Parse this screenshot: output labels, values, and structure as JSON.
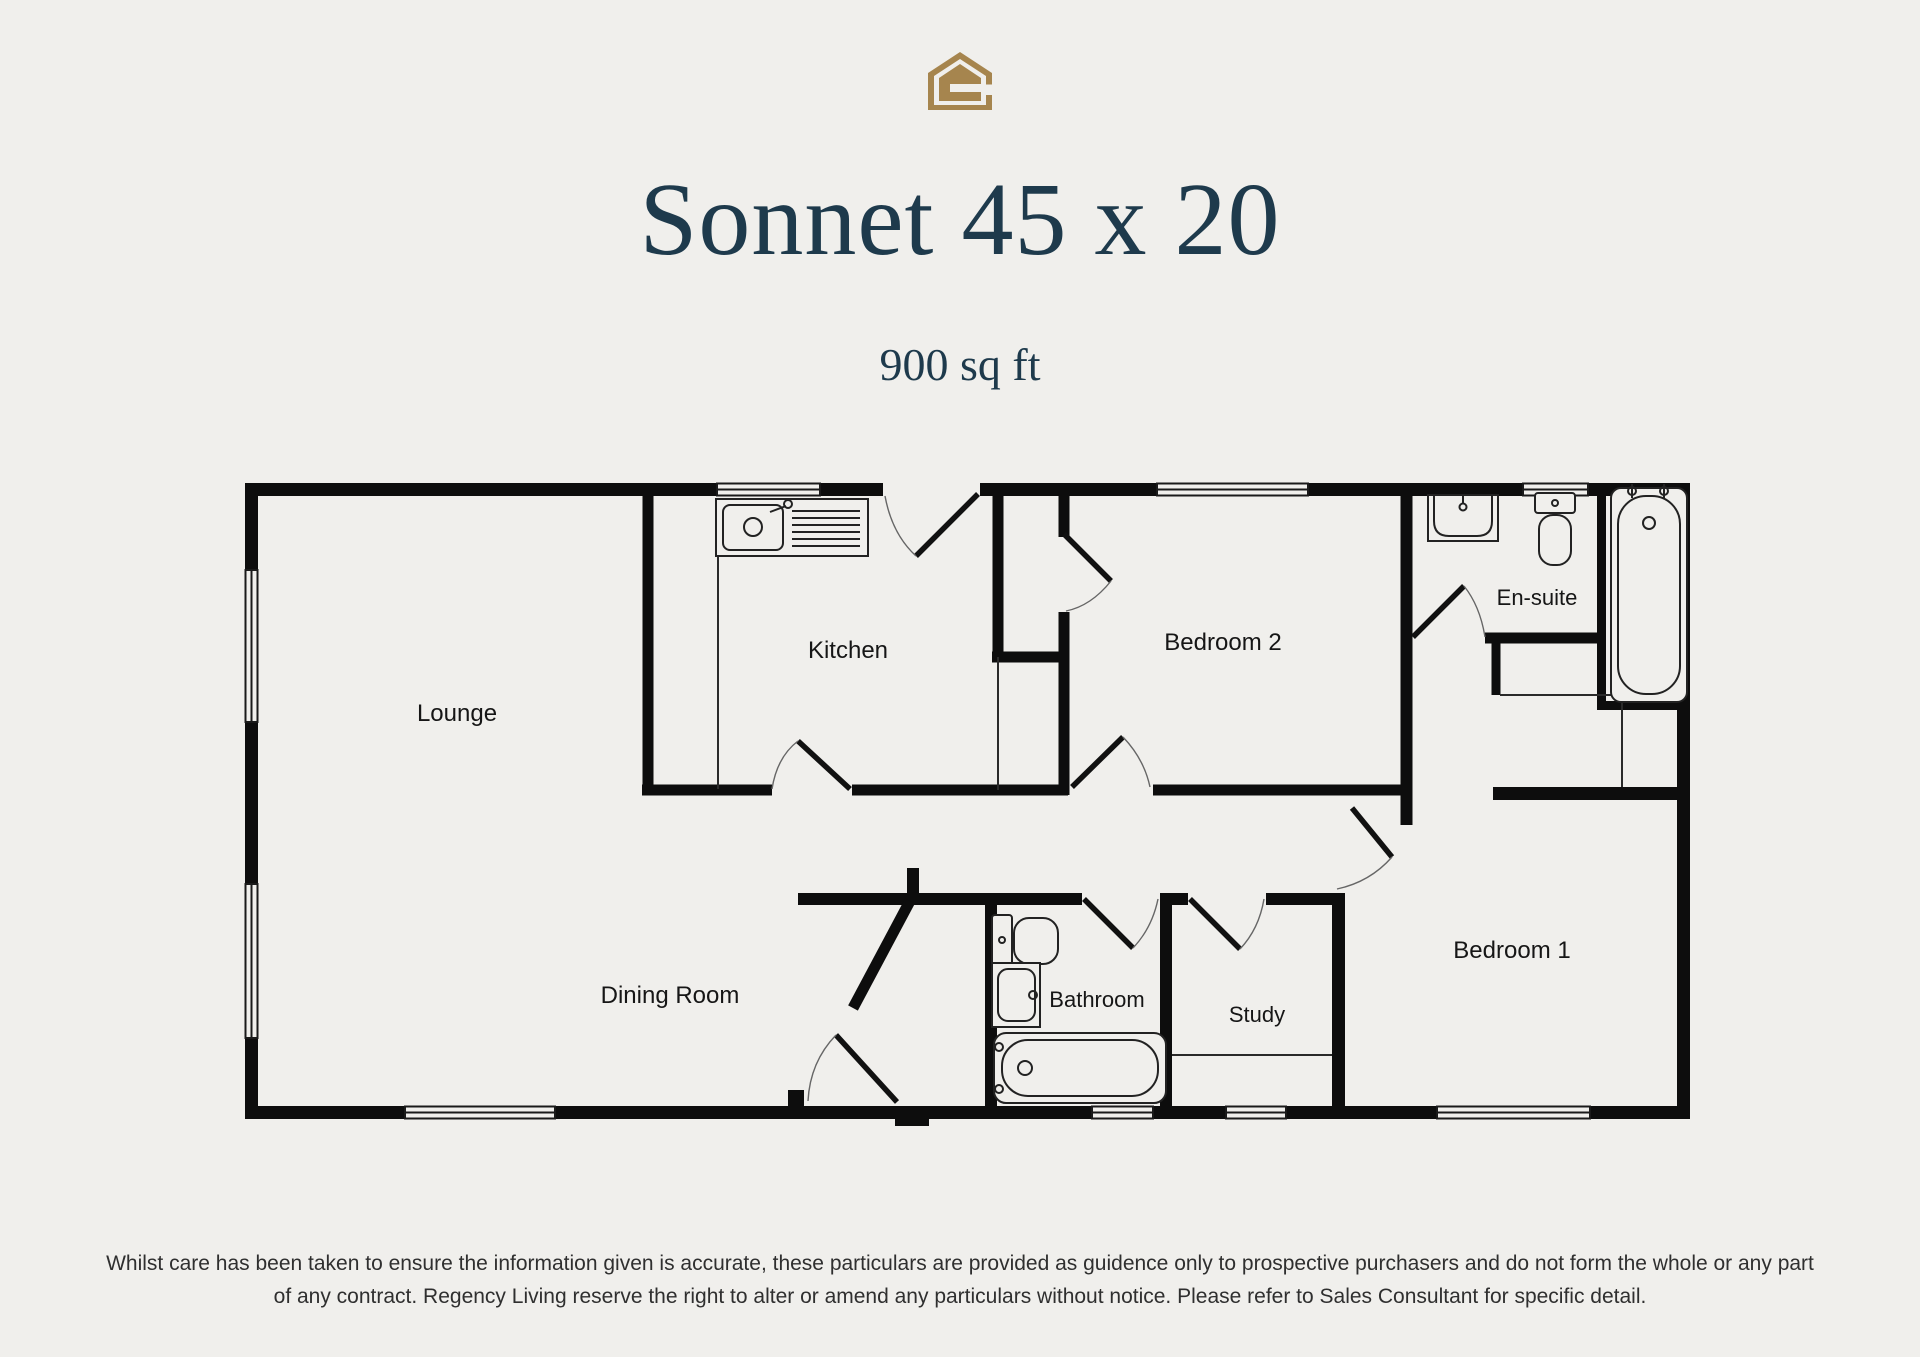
{
  "colors": {
    "background": "#f0efec",
    "wall": "#0d0d0d",
    "title_navy": "#1e3a4c",
    "logo_gold": "#a6854e",
    "disclaimer_gray": "#2f2f2f"
  },
  "header": {
    "logo_icon": "regency-living-house-logo",
    "title": "Sonnet 45 x 20",
    "subtitle": "900 sq ft"
  },
  "plan": {
    "rooms": [
      {
        "id": "lounge",
        "label": "Lounge"
      },
      {
        "id": "kitchen",
        "label": "Kitchen"
      },
      {
        "id": "bedroom-2",
        "label": "Bedroom 2"
      },
      {
        "id": "en-suite",
        "label": "En-suite"
      },
      {
        "id": "dining-room",
        "label": "Dining Room"
      },
      {
        "id": "bathroom",
        "label": "Bathroom"
      },
      {
        "id": "study",
        "label": "Study"
      },
      {
        "id": "bedroom-1",
        "label": "Bedroom 1"
      }
    ],
    "fixtures": [
      "kitchen-sink",
      "bathroom-toilet",
      "bathroom-basin",
      "bathroom-bath",
      "ensuite-basin",
      "ensuite-toilet",
      "ensuite-bath",
      "bedroom1-wardrobe",
      "study-desk"
    ]
  },
  "footer": {
    "disclaimer_line1": "Whilst care has been taken to ensure the information given is accurate, these particulars are provided as guidence only to prospective purchasers and do not form the whole or any part",
    "disclaimer_line2": "of any contract. Regency Living reserve the right to alter or amend any particulars without notice. Please refer to Sales Consultant for specific detail."
  }
}
